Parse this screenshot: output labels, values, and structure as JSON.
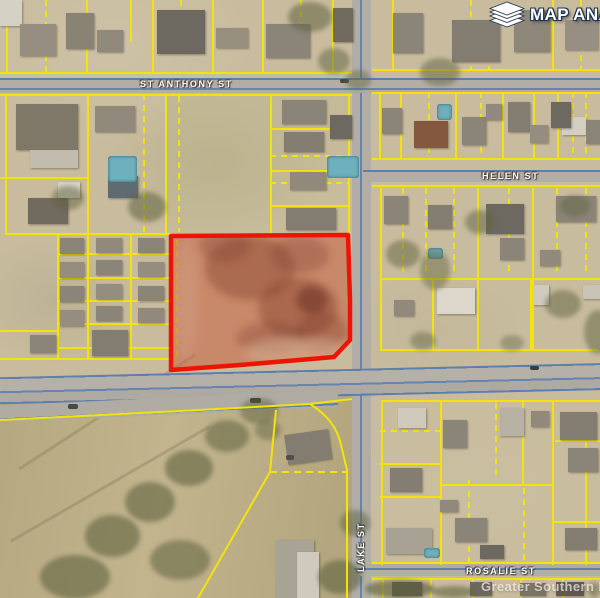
{
  "map": {
    "streets": {
      "st_anthony": "ST ANTHONY ST",
      "helen": "HELEN ST",
      "lake": "LAKE ST",
      "rosalie": "ROSALIE ST"
    },
    "highlighted_parcel": {
      "outline_color": "#ee1405",
      "fill_color": "rgba(199,85,54,0.5)"
    },
    "parcel_line_color": "#f2e40a",
    "road_line_color": "#5d7fae"
  },
  "branding": {
    "logo_text": "MAP ANA",
    "logo_icon": "layers-icon"
  },
  "watermark": {
    "text": "Greater Southern MLS"
  }
}
